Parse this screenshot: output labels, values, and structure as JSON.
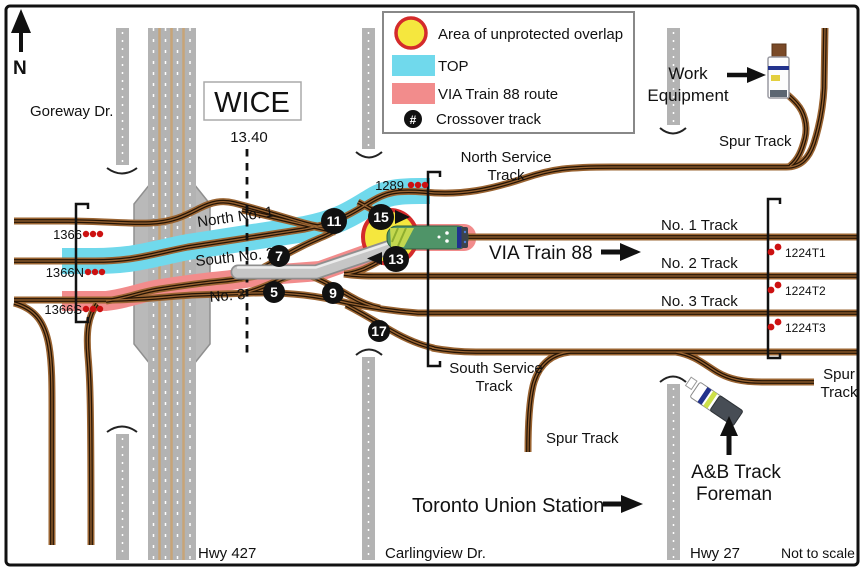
{
  "compass": {
    "label": "N"
  },
  "station_box": {
    "name": "WICE",
    "mileage": "13.40"
  },
  "legend": {
    "overlap": "Area of unprotected overlap",
    "top": "TOP",
    "via_route": "VIA Train 88 route",
    "crossover": "Crossover track",
    "crossover_symbol": "#"
  },
  "roads": {
    "goreway": "Goreway Dr.",
    "hwy427": "Hwy 427",
    "carlingview": "Carlingview Dr.",
    "hwy27": "Hwy 27"
  },
  "track_labels": {
    "north_no1": "North No. 1",
    "south_no2": "South No. 2",
    "no3_left": "No. 3",
    "north_service_1": "North Service",
    "north_service_2": "Track",
    "no1": "No. 1 Track",
    "no2": "No. 2 Track",
    "no3": "No. 3 Track",
    "south_service_1": "South Service",
    "south_service_2": "Track",
    "spur_top": "Spur Track",
    "spur_right_1": "Spur",
    "spur_right_2": "Track",
    "spur_bottom": "Spur Track"
  },
  "signals": {
    "s1366": "1366",
    "s1366n": "1366N",
    "s1366s": "1366S",
    "s1289": "1289",
    "t1": "1224T1",
    "t2": "1224T2",
    "t3": "1224T3"
  },
  "crossovers": {
    "c5": "5",
    "c7": "7",
    "c9": "9",
    "c11": "11",
    "c13": "13",
    "c15": "15",
    "c17": "17"
  },
  "annotations": {
    "via_train": "VIA Train 88",
    "work_1": "Work",
    "work_2": "Equipment",
    "foreman_1": "A&B Track",
    "foreman_2": "Foreman",
    "union": "Toronto Union Station",
    "scale": "Not to scale"
  },
  "colors": {
    "top_band": "#70d9ec",
    "via_band": "#f28c8c",
    "overlap_fill": "#f5e73e",
    "overlap_ring": "#d42b2b",
    "track_brown": "#9a6432",
    "track_core": "#241405",
    "road_gray": "#b3b3b3"
  }
}
